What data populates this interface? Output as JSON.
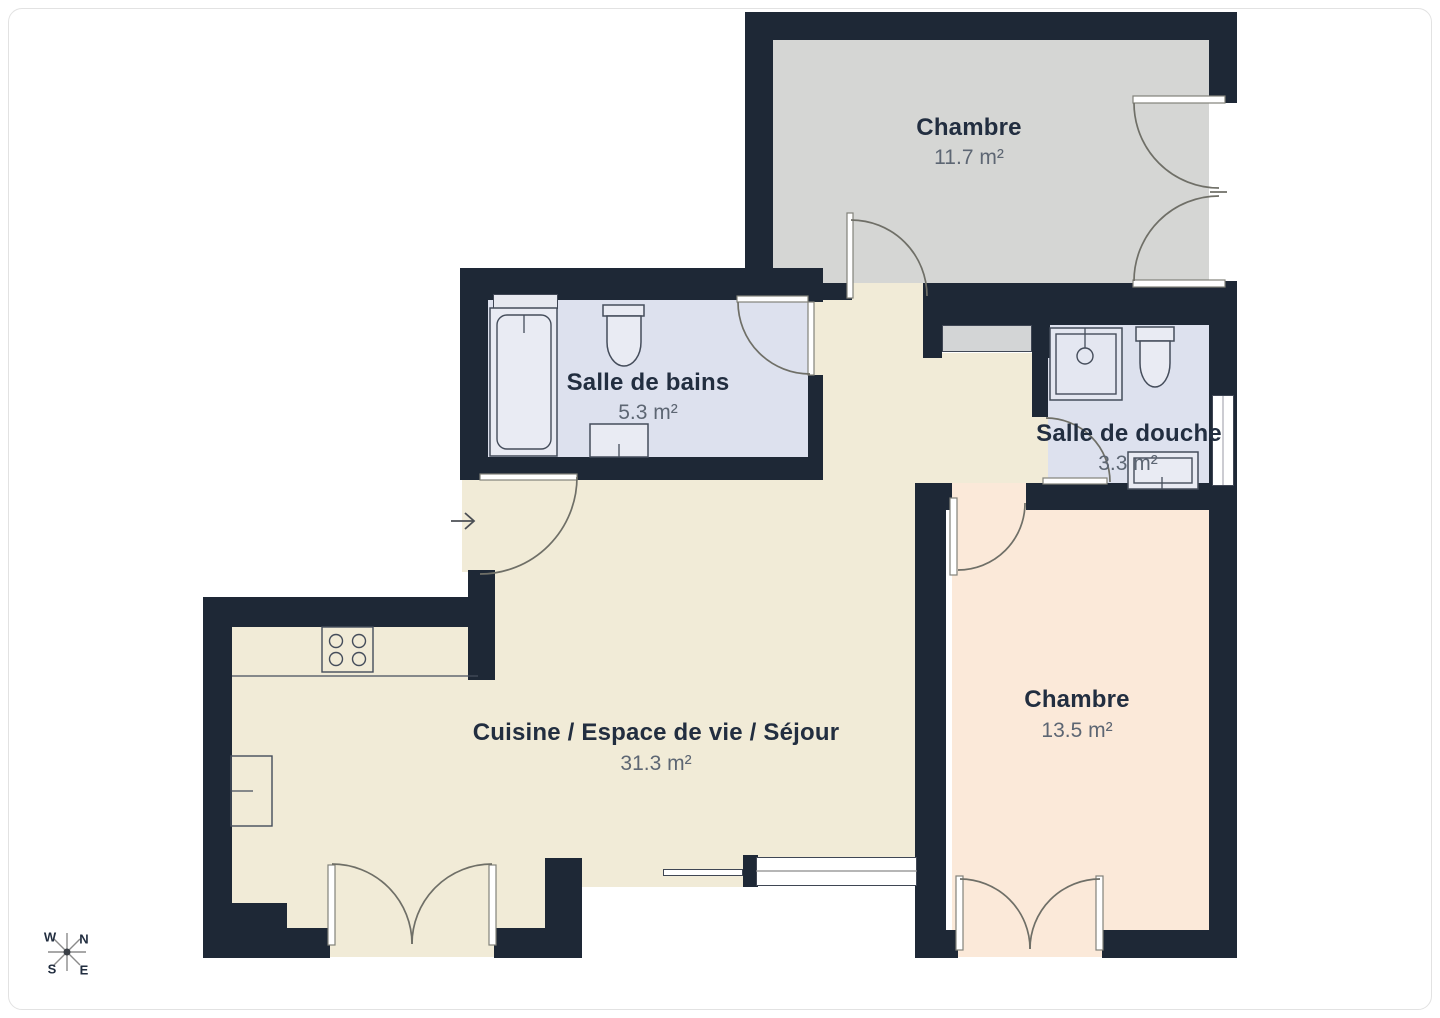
{
  "palette": {
    "wall": "#1e2836",
    "floor_living": "#f1ebd7",
    "floor_bedroom1": "#d5d6d4",
    "floor_bath": "#dde1ee",
    "floor_bedroom2": "#fbe9d9",
    "fixture_fill": "#e9ebf3",
    "shower_fill": "#e4e7f1",
    "window_fill": "#ffffff",
    "window_tint": "#e7e9f0",
    "arc": "#6f6f67",
    "outline": "#454d5b",
    "title_text": "#222e40",
    "area_text": "#5d6673",
    "compass": "#8b8b8b"
  },
  "rooms": [
    {
      "name": "Chambre",
      "area": "11.7 m²"
    },
    {
      "name": "Salle de bains",
      "area": "5.3 m²"
    },
    {
      "name": "Salle de douche",
      "area": "3.3 m²"
    },
    {
      "name": "Cuisine / Espace de vie / Séjour",
      "area": "31.3 m²"
    },
    {
      "name": "Chambre",
      "area": "13.5 m²"
    }
  ],
  "compass": {
    "west": "W",
    "north": "N",
    "south": "S",
    "east": "E"
  },
  "icons": {
    "entry_arrow": "→",
    "compass_star": "✳"
  }
}
